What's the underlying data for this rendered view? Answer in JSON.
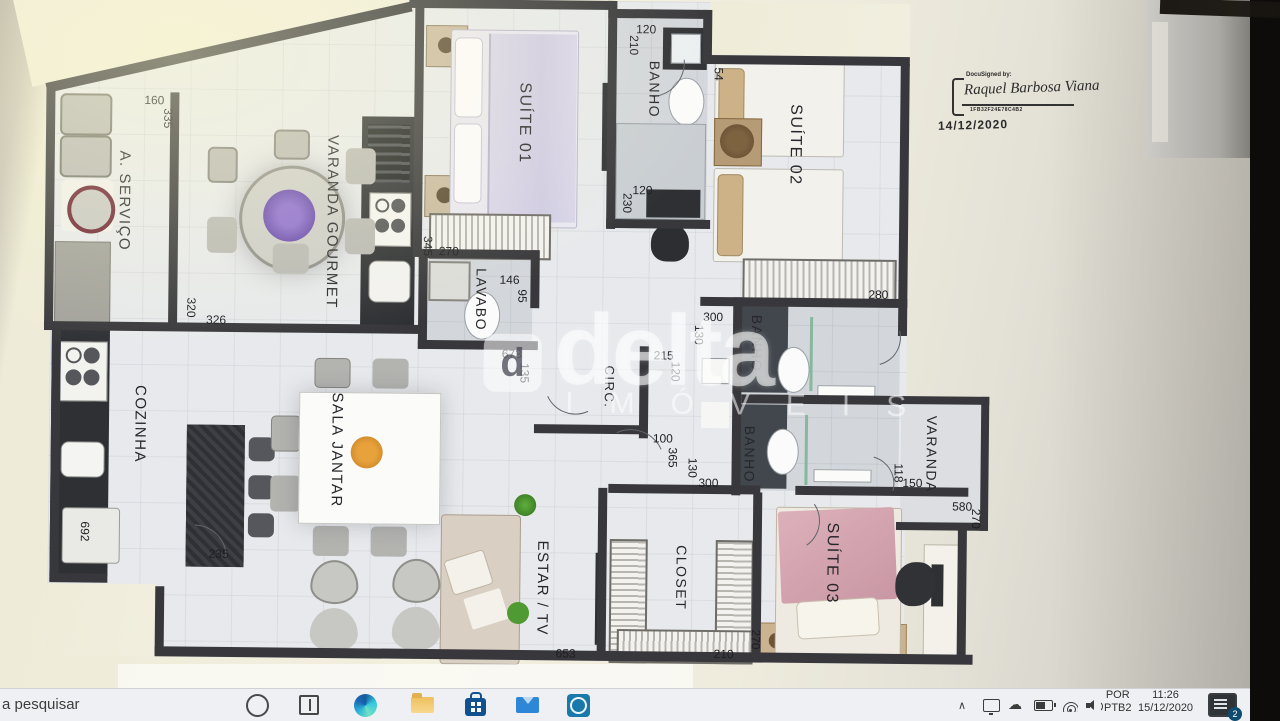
{
  "taskbar": {
    "search_text": "a pesquisar",
    "app_icons": [
      "cortana",
      "task-view",
      "edge",
      "file-explorer",
      "microsoft-store",
      "mail",
      "dell"
    ],
    "tray": {
      "chevron": "∧",
      "cloud_glyph": "☁",
      "language": "POR",
      "keyboard": "PTB2",
      "time": "11:26",
      "date": "15/12/2020",
      "notification_count": "2"
    }
  },
  "stamp": {
    "prefix": "DocuSigned by:",
    "name": "Raquel Barbosa Viana",
    "code": "1FB32F24E78C4B2",
    "date": "14/12/2020"
  },
  "watermark": {
    "logo_letter": "d",
    "brand": "delta",
    "sub": "IMÓVEIS"
  },
  "plan": {
    "room_labels": [
      {
        "t": "A. SERVIÇO",
        "x": 123,
        "y": 205,
        "fs": 15
      },
      {
        "t": "VARANDA GOURMET",
        "x": 331,
        "y": 224,
        "fs": 15
      },
      {
        "t": "SUÍTE 01",
        "x": 522,
        "y": 123,
        "fs": 16
      },
      {
        "t": "BANHO",
        "x": 652,
        "y": 88,
        "fs": 14
      },
      {
        "t": "SUÍTE 02",
        "x": 793,
        "y": 142,
        "fs": 16
      },
      {
        "t": "LAVABO",
        "x": 481,
        "y": 300,
        "fs": 14
      },
      {
        "t": "CIRC.",
        "x": 610,
        "y": 386,
        "fs": 13
      },
      {
        "t": "BANHO",
        "x": 757,
        "y": 341,
        "fs": 14
      },
      {
        "t": "BANHO",
        "x": 751,
        "y": 452,
        "fs": 14
      },
      {
        "t": "COZINHA",
        "x": 141,
        "y": 428,
        "fs": 15
      },
      {
        "t": "SALA JANTAR",
        "x": 338,
        "y": 452,
        "fs": 15
      },
      {
        "t": "ESTAR / TV",
        "x": 545,
        "y": 588,
        "fs": 15
      },
      {
        "t": "CLOSET",
        "x": 684,
        "y": 576,
        "fs": 14
      },
      {
        "t": "SUÍTE 03",
        "x": 834,
        "y": 560,
        "fs": 16
      },
      {
        "t": "VARANDA",
        "x": 933,
        "y": 450,
        "fs": 14
      }
    ],
    "dims": [
      {
        "t": "160",
        "x": 152,
        "y": 104,
        "r": 0
      },
      {
        "t": "335",
        "x": 166,
        "y": 122,
        "r": 1
      },
      {
        "t": "320",
        "x": 191,
        "y": 311,
        "r": 1
      },
      {
        "t": "326",
        "x": 216,
        "y": 323,
        "r": 0
      },
      {
        "t": "345",
        "x": 427,
        "y": 247,
        "r": 1
      },
      {
        "t": "270",
        "x": 448,
        "y": 252,
        "r": 0
      },
      {
        "t": "146",
        "x": 509,
        "y": 280,
        "r": 0
      },
      {
        "t": "95",
        "x": 522,
        "y": 296,
        "r": 1
      },
      {
        "t": "120",
        "x": 643,
        "y": 28,
        "r": 0
      },
      {
        "t": "210",
        "x": 631,
        "y": 44,
        "r": 1
      },
      {
        "t": "54",
        "x": 716,
        "y": 72,
        "r": 1
      },
      {
        "t": "120",
        "x": 641,
        "y": 189,
        "r": 0
      },
      {
        "t": "230",
        "x": 626,
        "y": 202,
        "r": 1
      },
      {
        "t": "280",
        "x": 878,
        "y": 291,
        "r": 0
      },
      {
        "t": "300",
        "x": 713,
        "y": 315,
        "r": 0
      },
      {
        "t": "130",
        "x": 699,
        "y": 333,
        "r": 1
      },
      {
        "t": "673",
        "x": 512,
        "y": 354,
        "r": 0
      },
      {
        "t": "135",
        "x": 525,
        "y": 373,
        "r": 1
      },
      {
        "t": "215",
        "x": 664,
        "y": 354,
        "r": 0
      },
      {
        "t": "120",
        "x": 676,
        "y": 370,
        "r": 1
      },
      {
        "t": "100",
        "x": 664,
        "y": 437,
        "r": 0
      },
      {
        "t": "365",
        "x": 674,
        "y": 456,
        "r": 1
      },
      {
        "t": "130",
        "x": 694,
        "y": 466,
        "r": 1
      },
      {
        "t": "300",
        "x": 710,
        "y": 481,
        "r": 0
      },
      {
        "t": "118",
        "x": 900,
        "y": 469,
        "r": 1
      },
      {
        "t": "150",
        "x": 914,
        "y": 479,
        "r": 0
      },
      {
        "t": "580",
        "x": 964,
        "y": 502,
        "r": 0
      },
      {
        "t": "270",
        "x": 978,
        "y": 514,
        "r": 1
      },
      {
        "t": "692",
        "x": 87,
        "y": 536,
        "r": 1
      },
      {
        "t": "235",
        "x": 221,
        "y": 557,
        "r": 0
      },
      {
        "t": "653",
        "x": 569,
        "y": 653,
        "r": 0
      },
      {
        "t": "210",
        "x": 727,
        "y": 652,
        "r": 0
      },
      {
        "t": "270",
        "x": 759,
        "y": 637,
        "r": 1
      }
    ]
  }
}
